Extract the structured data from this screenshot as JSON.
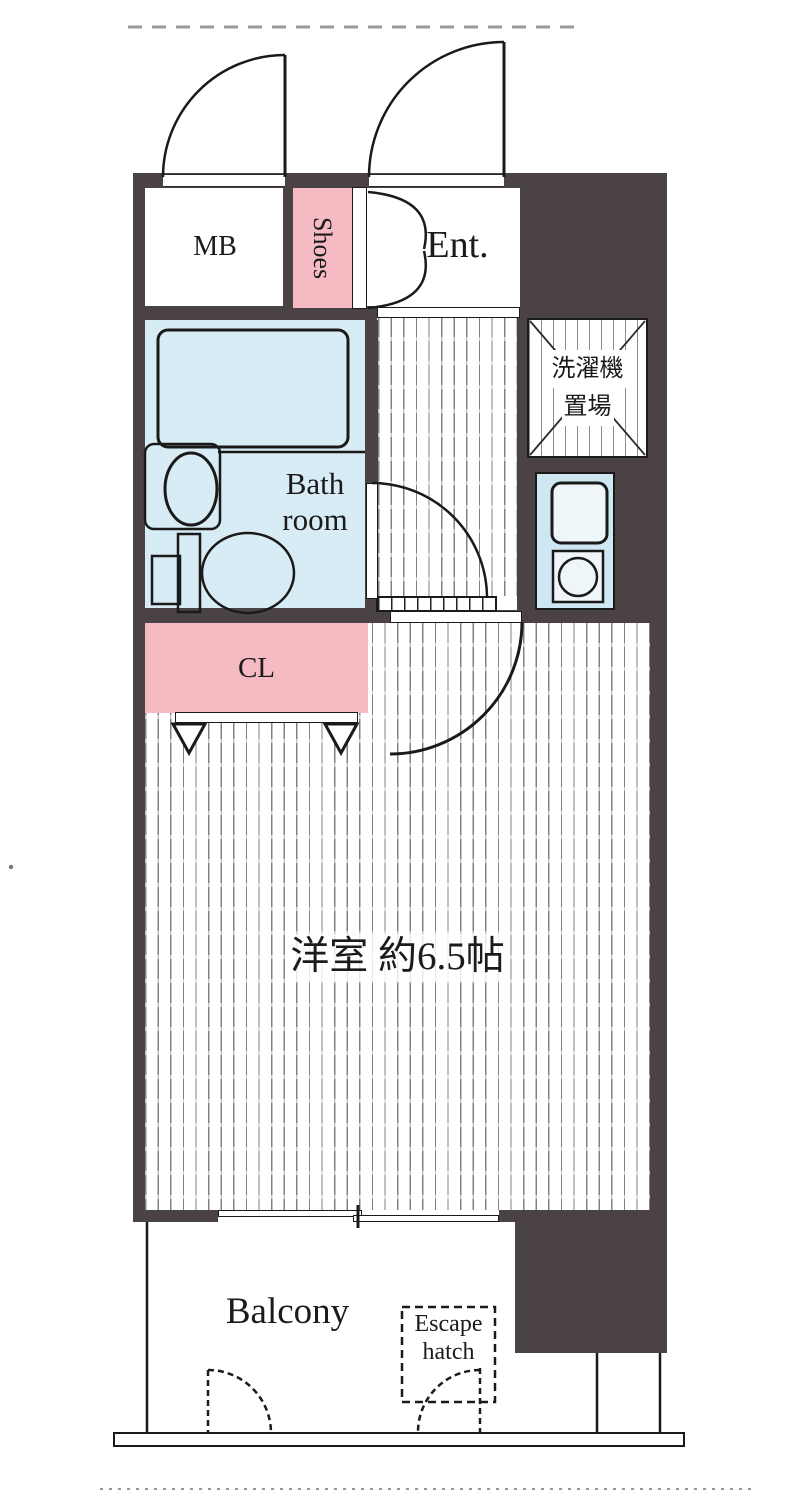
{
  "title": "apartment-floor-plan",
  "labels": {
    "mb": "MB",
    "shoes": "Shoes",
    "ent": "Ent.",
    "laundry1": "洗濯機",
    "laundry2": "置場",
    "bath1": "Bath",
    "bath2": "room",
    "cl": "CL",
    "main_room": "洋室 約6.5帖",
    "balcony": "Balcony",
    "escape1": "Escape",
    "escape2": "hatch"
  },
  "colors": {
    "wall": "#4b4245",
    "closet_pink": "#f5bac2",
    "shoes_pink": "#f5bac2",
    "bath_blue": "#d8ecf5",
    "kitchen_blue": "#cfe7f2",
    "line": "#1a1a1a",
    "background": "#ffffff"
  }
}
